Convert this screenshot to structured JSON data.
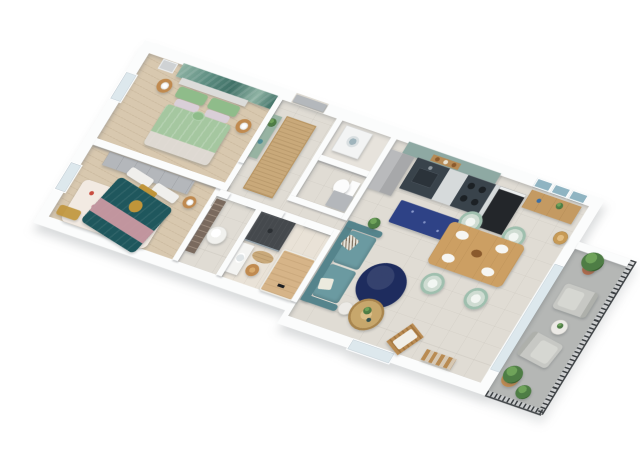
{
  "scene": {
    "kind": "3d-isometric-floor-plan-rendering",
    "text_visible": false,
    "background": "#ffffff"
  },
  "colors": {
    "bg": "#ffffff",
    "wall-face": "#fbfcfc",
    "wall-shade": "#c9cdd1",
    "wood-floor": "#d8c8af",
    "tile-floor": "#e0dcd4",
    "tile-light": "#e7e3dc",
    "bath-floor": "#e9e2d7",
    "balcony-floor": "#b5b7b5",
    "mural-a": "#5d8d81",
    "mural-b": "#3f7066",
    "mural-c": "#8fb3a4",
    "bed-sage": "#a5c7a0",
    "pillow-green": "#8fbc8a",
    "pillow-lilac": "#d9cfd8",
    "headboard": "#dcdcda",
    "foot-sheet": "#e7dcda",
    "rattan": "#c08a4f",
    "lamp-white": "#f4f4f2",
    "wardrobe": "#b4b7bb",
    "bed-teal": "#1f575d",
    "throw-pink": "#cf9aa4",
    "mustard": "#c0953a",
    "rug-floral-base": "#f2eae2",
    "console-green": "#97b3a2",
    "jute": "#c9a97a",
    "toilet-white": "#fcfcfc",
    "washer-white": "#f3f4f4",
    "fridge-gray": "#a7a8aa",
    "cabinet-sage": "#8ea9a3",
    "counter-base": "#d6dadb",
    "counter-dark": "#39434b",
    "oven-black": "#23262a",
    "rug-navy": "#2e4286",
    "rug-navy-round": "#1e2c5e",
    "sofa-teal": "#6b9aa1",
    "sofa-teal-dark": "#55848c",
    "table-wood": "#cc9f63",
    "chair-wicker": "#cfdcd2",
    "chair-wicker-ring": "#9fbfae",
    "sideboard-wood": "#c49a62",
    "art-teal": "#8fb4c2",
    "lampshade-rattan": "#c79a55",
    "shower-dark": "#45494d",
    "stool-wood": "#b5763b",
    "tub-deck": "#d6b488",
    "pouf-white": "#f1f1ee",
    "shoe-shelf": "#7a6a5e",
    "balcony-chair": "#c7c8c4",
    "rail-dark": "#3c4043",
    "plant-green": "#4e7d45",
    "plant-green2": "#6fa35a",
    "pot-terracotta": "#b06a4a",
    "side-table-white": "#eceae6",
    "door-gray": "#b4b8bc",
    "glass": "#dde8ed",
    "coffee-wicker": "#c7a76c"
  },
  "apartment": {
    "rooms": [
      {
        "id": "bedroom-1",
        "items": [
          "palm-leaf-wall-mural",
          "double-bed-sage-duvet",
          "green-pillows",
          "lilac-pillows",
          "rattan-nightstand-left",
          "rattan-nightstand-right",
          "white-table-lamp-left",
          "white-table-lamp-right",
          "wall-frame",
          "west-window"
        ]
      },
      {
        "id": "bedroom-2",
        "items": [
          "gray-wardrobe-row",
          "double-bed-teal-duvet",
          "pink-throw",
          "mustard-cushion",
          "floral-area-rug",
          "wood-nightstand",
          "table-lamp",
          "mustard-bench",
          "west-window"
        ]
      },
      {
        "id": "entry-hall",
        "items": [
          "entry-door",
          "green-console-with-plants",
          "jute-runner-rug"
        ]
      },
      {
        "id": "laundry-niche",
        "items": [
          "washing-machine"
        ]
      },
      {
        "id": "wc",
        "items": [
          "toilet",
          "gray-storage-cabinet"
        ]
      },
      {
        "id": "dressing-room",
        "items": [
          "shoe-shelving",
          "white-quilted-pouf"
        ]
      },
      {
        "id": "bathroom",
        "items": [
          "dark-walk-in-shower",
          "vanity-with-basin",
          "wood-stool",
          "jute-mat",
          "wood-deck-bathtub",
          "black-shower-column"
        ]
      },
      {
        "id": "kitchen",
        "items": [
          "sage-upper-cabinets",
          "open-shelf-with-jars",
          "fridge",
          "counter-with-sink",
          "dark-cooktop",
          "black-oven",
          "navy-speckled-rug"
        ]
      },
      {
        "id": "living-dining",
        "items": [
          "wood-sideboard",
          "three-framed-artworks",
          "rattan-floor-lamp",
          "wood-dining-table",
          "four-wicker-peacock-chairs",
          "table-settings",
          "round-navy-rug",
          "teal-sofa",
          "patterned-cushions",
          "white-side-table",
          "potted-plant",
          "round-wicker-coffee-table",
          "wood-folding-lounge-chair",
          "wood-ladder-shelf",
          "glass-balcony-door",
          "south-window"
        ]
      },
      {
        "id": "balcony",
        "items": [
          "metal-railing",
          "white-parapet",
          "terracotta-potted-plant",
          "gray-outdoor-armchair-north",
          "gray-outdoor-armchair-south",
          "round-white-side-table",
          "green-plants-south"
        ]
      }
    ]
  }
}
